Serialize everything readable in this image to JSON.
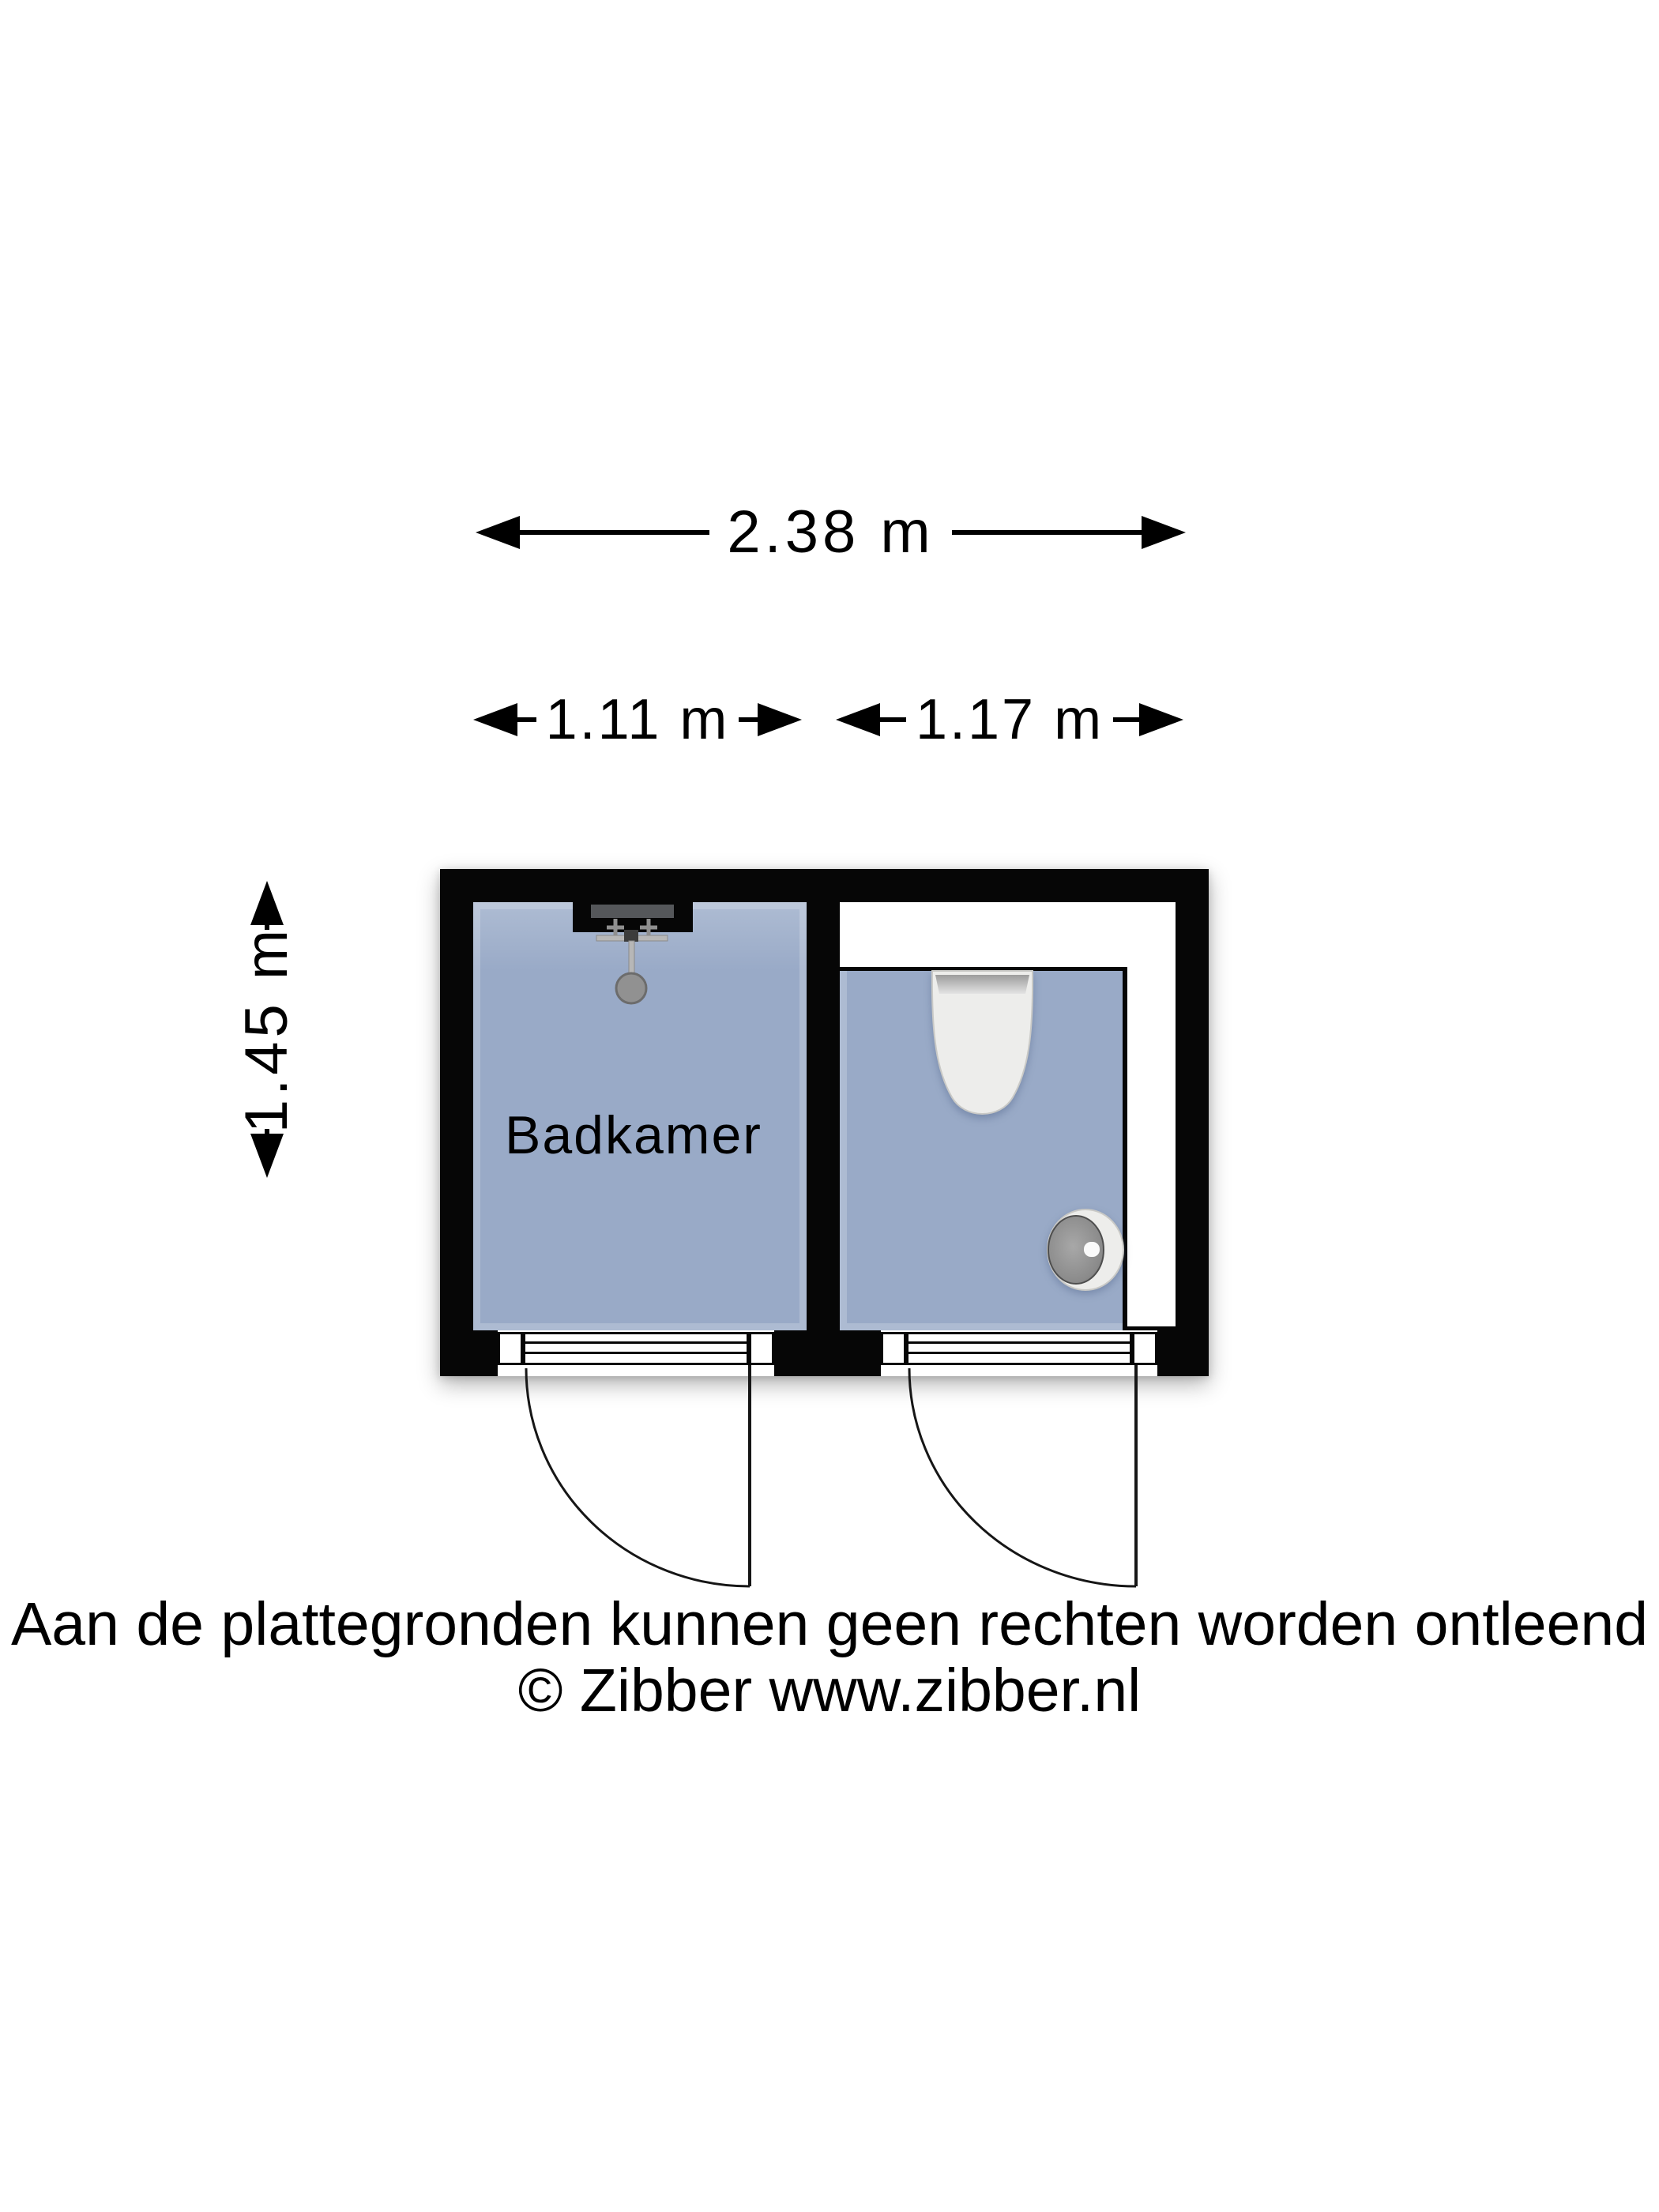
{
  "dimensions": {
    "total_width": "2.38 m",
    "left_room_width": "1.11 m",
    "right_room_width": "1.17 m",
    "height": "1.45 m"
  },
  "rooms": {
    "left": "Badkamer"
  },
  "fixtures": {
    "left_room": [
      "shower"
    ],
    "right_room": [
      "toilet",
      "hand-basin"
    ],
    "doors": [
      "left-swing-door",
      "right-swing-door"
    ]
  },
  "footer": {
    "disclaimer": "Aan de plattegronden kunnen geen rechten worden ontleend",
    "copyright": "© Zibber www.zibber.nl"
  },
  "colors": {
    "wall": "#060606",
    "room_fill": "#99aac7",
    "room_fill_light": "#aebcd3",
    "fixture_white": "#ededeb",
    "fixture_metal": "#919191",
    "niche_gray": "#55575a",
    "line": "#161616",
    "background": "#ffffff"
  }
}
